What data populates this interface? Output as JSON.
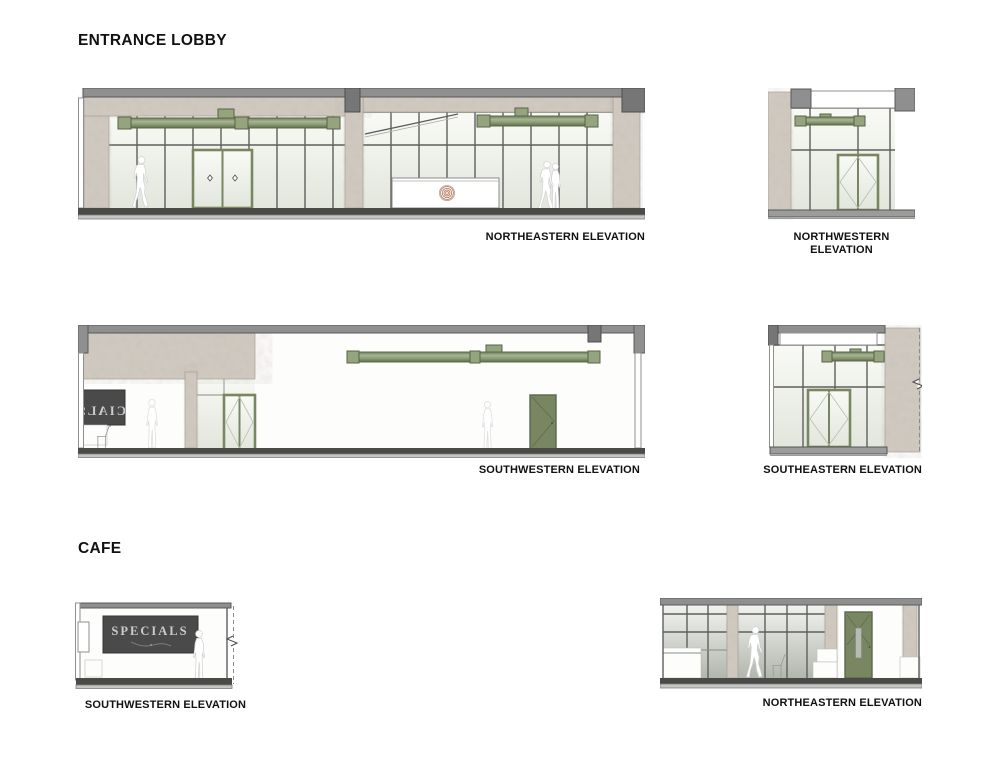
{
  "titles": {
    "lobby": "ENTRANCE LOBBY",
    "cafe": "CAFE"
  },
  "elevations": [
    {
      "id": "lobby-northeastern",
      "label": "NORTHEASTERN ELEVATION"
    },
    {
      "id": "lobby-northwestern",
      "label": "NORTHWESTERN ELEVATION"
    },
    {
      "id": "lobby-southwestern",
      "label": "SOUTHWESTERN ELEVATION"
    },
    {
      "id": "lobby-southeastern",
      "label": "SOUTHEASTERN ELEVATION"
    },
    {
      "id": "cafe-southwestern",
      "label": "SOUTHWESTERN ELEVATION"
    },
    {
      "id": "cafe-northeastern",
      "label": "NORTHEASTERN ELEVATION"
    }
  ],
  "signs": {
    "specials": "SPECIALS"
  },
  "colors": {
    "background": "#ffffff",
    "label_text": "#111111",
    "accent_green": "#8a9a77",
    "accent_green_dark": "#5a6a47",
    "door_green": "#788762",
    "concrete": "#d2cbc2",
    "cap_gray": "#8f8f8f",
    "cap_dark": "#5a5a5a",
    "mullion": "#5f5f5f",
    "floor_dark": "#4a4a47",
    "floor_gray": "#9c9c9a",
    "glass_top": "#f9faf6",
    "glass_bottom": "#e2e6dc",
    "glass_dark_bottom": "#b2b7ae",
    "sign_board": "#4a4a4a",
    "sign_text": "#cbcbcb",
    "logo_copper": "#b5826a"
  }
}
